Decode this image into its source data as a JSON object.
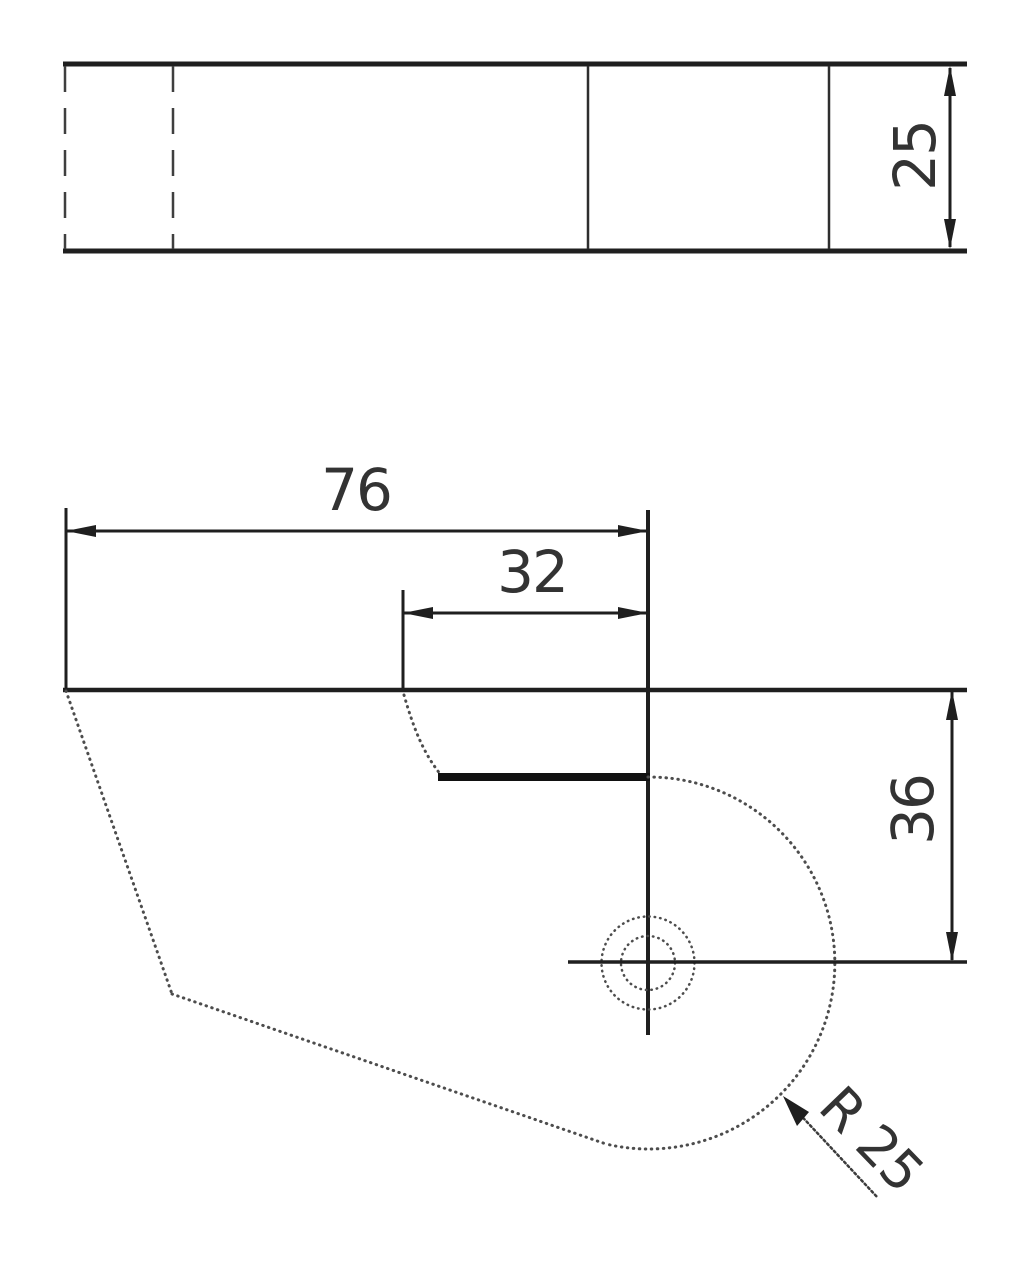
{
  "labels": {
    "thickness": "25",
    "overall_width": "76",
    "step_width": "32",
    "center_height": "36",
    "radius": "R 25"
  },
  "colors": {
    "main_line": "#1f1f1f",
    "thin_line": "#4d4d4d",
    "text": "#333333",
    "background": "#ffffff"
  }
}
